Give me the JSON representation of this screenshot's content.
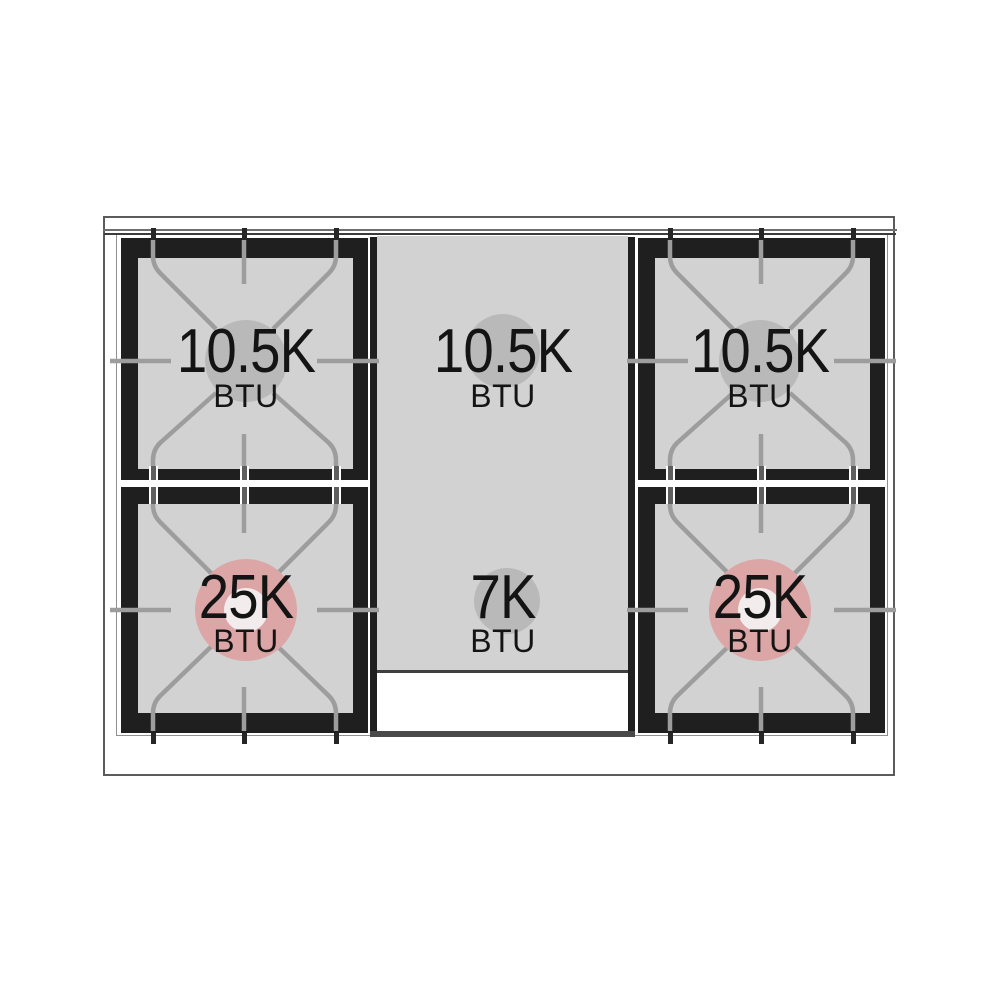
{
  "diagram": {
    "type": "range-cooktop-burner-layout",
    "burners": [
      {
        "position": "left-rear",
        "value": "10.5K",
        "unit": "BTU",
        "highlight": "gray"
      },
      {
        "position": "center-rear",
        "value": "10.5K",
        "unit": "BTU",
        "highlight": "gray"
      },
      {
        "position": "right-rear",
        "value": "10.5K",
        "unit": "BTU",
        "highlight": "gray"
      },
      {
        "position": "left-front",
        "value": "25K",
        "unit": "BTU",
        "highlight": "pink"
      },
      {
        "position": "center-front",
        "value": "7K",
        "unit": "BTU",
        "highlight": "gray"
      },
      {
        "position": "right-front",
        "value": "25K",
        "unit": "BTU",
        "highlight": "pink"
      }
    ],
    "colors": {
      "plate_black": "#1f1f1f",
      "surface_gray": "#d2d2d2",
      "circle_gray": "#b9b9b9",
      "highlight_pink": "#dca6a6",
      "highlight_core": "#f2ecec",
      "grate_line": "#9d9d9d",
      "frame_outline": "#5b5b5b"
    }
  }
}
